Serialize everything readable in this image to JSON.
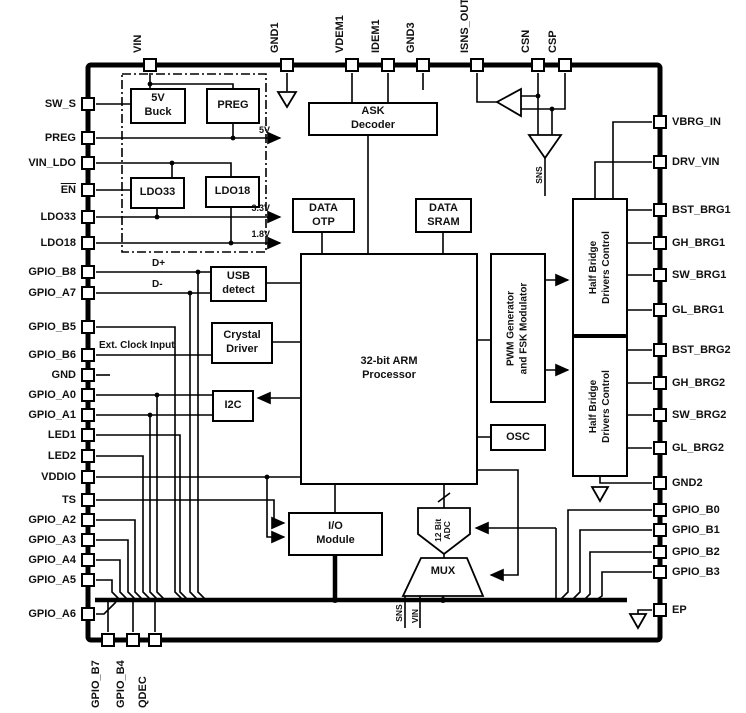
{
  "title": "IC functional block diagram",
  "pins": {
    "top": [
      "VIN",
      "GND1",
      "VDEM1",
      "IDEM1",
      "GND3",
      "ISNS_OUT",
      "CSN",
      "CSP"
    ],
    "left": [
      "SW_S",
      "PREG",
      "VIN_LDO",
      "EN",
      "LDO33",
      "LDO18",
      "GPIO_B8",
      "GPIO_A7",
      "GPIO_B5",
      "GPIO_B6",
      "GND",
      "GPIO_A0",
      "GPIO_A1",
      "LED1",
      "LED2",
      "VDDIO",
      "TS",
      "GPIO_A2",
      "GPIO_A3",
      "GPIO_A4",
      "GPIO_A5",
      "GPIO_A6"
    ],
    "right": [
      "VBRG_IN",
      "DRV_VIN",
      "BST_BRG1",
      "GH_BRG1",
      "SW_BRG1",
      "GL_BRG1",
      "BST_BRG2",
      "GH_BRG2",
      "SW_BRG2",
      "GL_BRG2",
      "GND2",
      "GPIO_B0",
      "GPIO_B1",
      "GPIO_B2",
      "GPIO_B3",
      "EP"
    ],
    "bottom": [
      "GPIO_B7",
      "GPIO_B4",
      "QDEC"
    ]
  },
  "blocks": {
    "buck": "5V\nBuck",
    "preg": "PREG",
    "ldo33": "LDO33",
    "ldo18": "LDO18",
    "ask": "ASK\nDecoder",
    "data_otp": "DATA\nOTP",
    "data_sram": "DATA\nSRAM",
    "usb": "USB\ndetect",
    "crystal": "Crystal\nDriver",
    "i2c": "I2C",
    "arm": "32-bit ARM\nProcessor",
    "pwm": "PWM Generator\nand FSK Modulator",
    "osc": "OSC",
    "io": "I/O\nModule",
    "hb1": "Half Bridge\nDrivers Control",
    "hb2": "Half Bridge\nDrivers Control",
    "adc": "12 Bit\nADC",
    "mux": "MUX"
  },
  "labels": {
    "rail_5v": "5V",
    "rail_3v3": "3.3V",
    "rail_1v8": "1.8V",
    "d_plus": "D+",
    "d_minus": "D-",
    "ext_clock": "Ext. Clock Input",
    "sns_amp": "SNS",
    "mux_sns": "SNS",
    "mux_vin": "VIN"
  },
  "colors": {
    "line": "#000000",
    "background": "#ffffff",
    "text": "#111111"
  }
}
